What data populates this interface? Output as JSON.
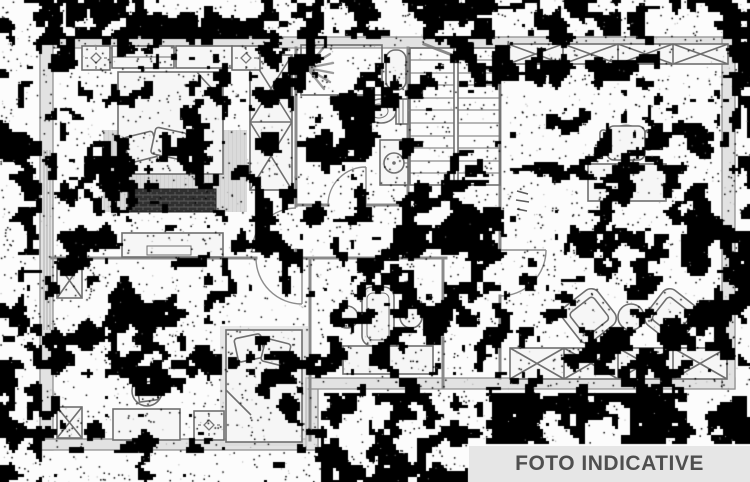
{
  "banner": {
    "label": "FOTO INDICATIVE"
  },
  "colors": {
    "paper": "#fcfcfc",
    "wall": "#8a8a8a",
    "wall-fill": "#e2e2e2",
    "furniture": "#6f6f6f",
    "furniture-fill": "#f6f6f6",
    "rug": "#d9d9d9",
    "chest": "#333333",
    "noise": "#000000",
    "banner-bg": "#e6e6e6",
    "banner-text": "#4f4f4f"
  }
}
